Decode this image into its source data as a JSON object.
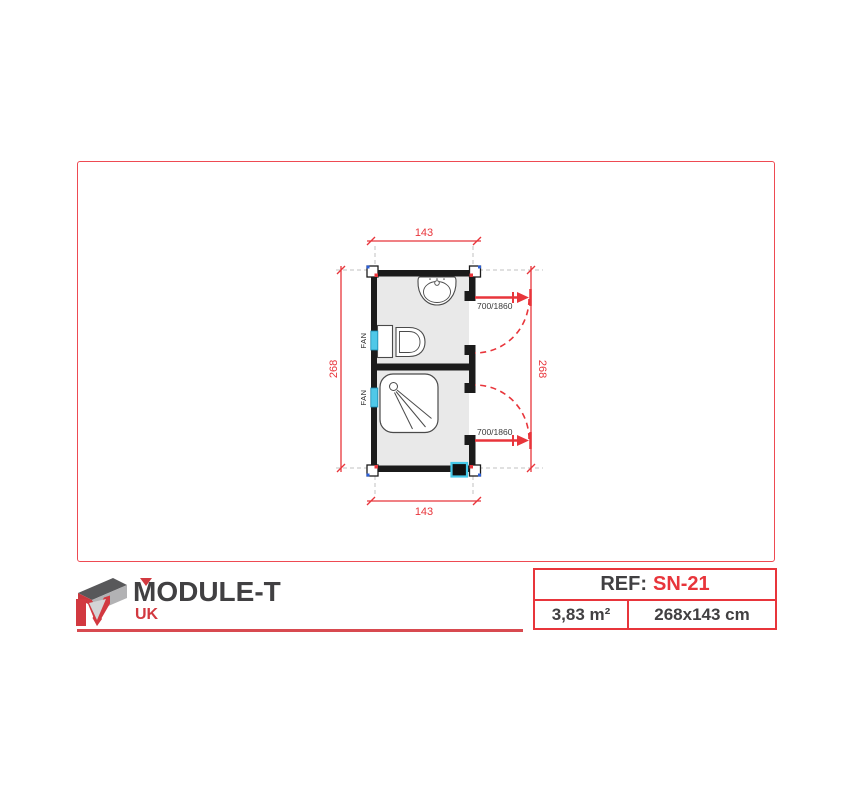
{
  "brand": {
    "wordmark": "MODULE-T",
    "region": "UK"
  },
  "title_block": {
    "ref_label": "REF:",
    "ref_value": "SN-21",
    "area": "3,83 m²",
    "size": "268x143 cm"
  },
  "plan": {
    "width_dim_top": "143",
    "width_dim_bottom": "143",
    "height_dim_left": "268",
    "height_dim_right": "268",
    "door_top_label": "700/1860",
    "door_bottom_label": "700/1860",
    "fan_upper": "FAN",
    "fan_lower": "FAN"
  },
  "colors": {
    "accent_red": "#e8353b",
    "logo_red": "#d23940",
    "dark_text": "#414042",
    "vent_cyan": "#4fc8e8",
    "wall_black": "#1b1b1b",
    "floor_gray": "#e9e9e9"
  }
}
